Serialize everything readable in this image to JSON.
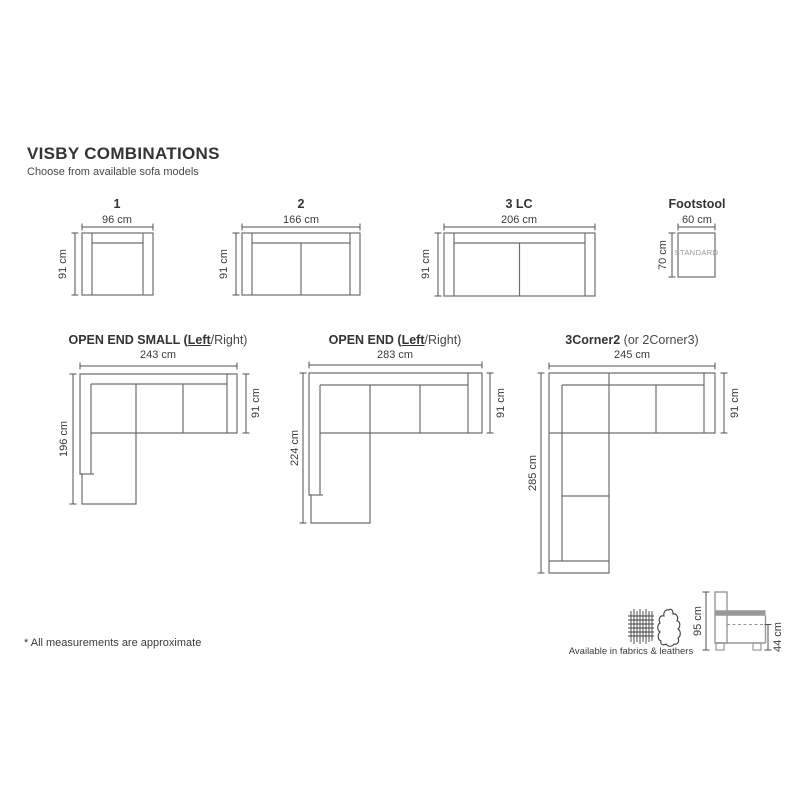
{
  "page": {
    "title": "VISBY COMBINATIONS",
    "subtitle": "Choose from available sofa models",
    "footnote": "* All measurements are approximate"
  },
  "row1": {
    "m1": {
      "label": "1",
      "width": "96 cm",
      "depth": "91 cm"
    },
    "m2": {
      "label": "2",
      "width": "166 cm",
      "depth": "91 cm"
    },
    "m3lc": {
      "label": "3 LC",
      "width": "206 cm",
      "depth": "91 cm"
    },
    "footstool": {
      "label": "Footstool",
      "width": "60 cm",
      "depth": "70 cm",
      "badge": "STANDARD"
    }
  },
  "row2": {
    "open_end_small": {
      "title_bold": "OPEN END SMALL (",
      "title_underline": "Left",
      "title_rest": "/Right)",
      "width": "243 cm",
      "height": "196 cm",
      "depth": "91 cm"
    },
    "open_end": {
      "title_bold": "OPEN END (",
      "title_underline": "Left",
      "title_rest": "/Right)",
      "width": "283 cm",
      "height": "224 cm",
      "depth": "91 cm"
    },
    "corner": {
      "title_bold": "3Corner2",
      "title_rest": " (or 2Corner3)",
      "width": "245 cm",
      "height": "285 cm",
      "depth": "91 cm"
    }
  },
  "footer": {
    "availability": "Available in fabrics & leathers",
    "side_view": {
      "height": "95 cm",
      "seat_height": "44 cm"
    }
  },
  "colors": {
    "line": "#6e6f71",
    "dim_line": "#515153",
    "side_gray": "#97989a",
    "text": "#3b3b3d"
  }
}
